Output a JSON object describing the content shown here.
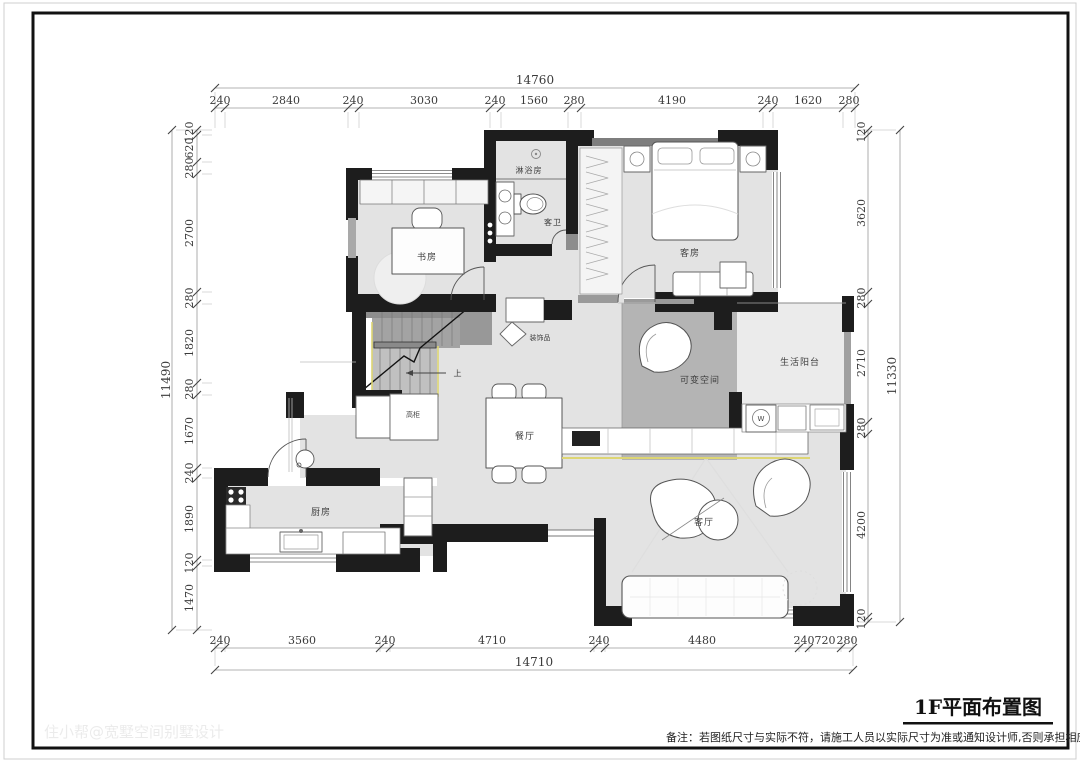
{
  "drawing": {
    "title": "1F平面布置图",
    "note": "备注：若图纸尺寸与实际不符，请施工人员以实际尺寸为准或通知设计师,否则承担相应责任！",
    "watermark": "住小帮@宽墅空间别墅设计"
  },
  "rooms": {
    "study": "书房",
    "shower_room": "淋浴房",
    "guest_bathroom": "客卫",
    "guest_bedroom": "客房",
    "flex_space": "可变空间",
    "service_balcony": "生活阳台",
    "dining_room": "餐厅",
    "kitchen": "厨房",
    "living_room": "客厅",
    "decoration": "装饰品",
    "tall_cabinet": "高柜",
    "stair_up": "上",
    "washer": "W"
  },
  "dimensions": {
    "top": {
      "total": "14760",
      "segments": [
        "240",
        "2840",
        "240",
        "3030",
        "240",
        "1560",
        "280",
        "4190",
        "240",
        "1620",
        "280"
      ]
    },
    "bottom": {
      "total": "14710",
      "segments": [
        "240",
        "3560",
        "240",
        "4710",
        "240",
        "4480",
        "240",
        "720",
        "280"
      ]
    },
    "left": {
      "total": "11490",
      "segments": [
        "120",
        "620",
        "280",
        "2700",
        "280",
        "1820",
        "280",
        "1670",
        "240",
        "1890",
        "120",
        "1470"
      ]
    },
    "right": {
      "total": "11330",
      "segments": [
        "120",
        "3620",
        "280",
        "2710",
        "280",
        "4200",
        "120"
      ]
    }
  },
  "colors": {
    "wall": "#1d1d1d",
    "floor": "#e3e3e3",
    "flex_floor": "#b4b4b4",
    "balcony_floor": "#ebebeb",
    "accent_yellow": "#ddd573"
  }
}
